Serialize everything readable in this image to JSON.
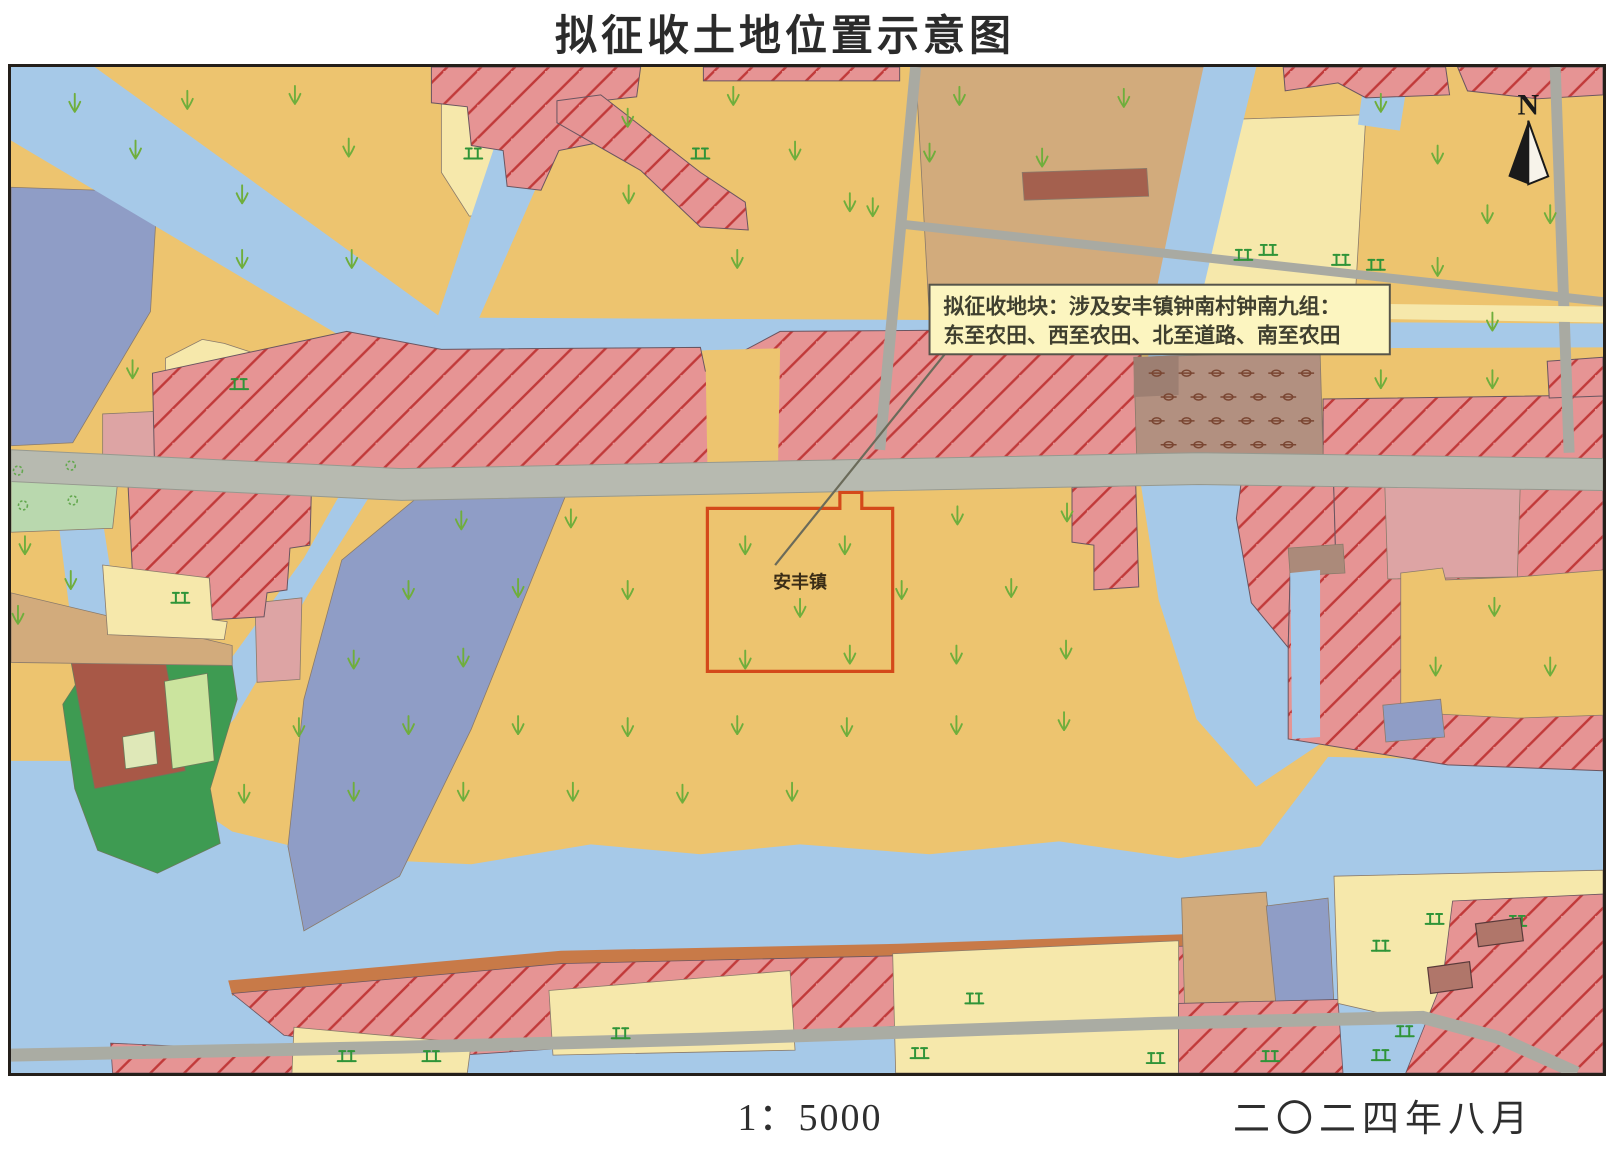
{
  "title": "拟征收土地位置示意图",
  "map": {
    "callout": {
      "line1": "拟征收地块：涉及安丰镇钟南村钟南九组：",
      "line2": "东至农田、西至农田、北至道路、南至农田"
    },
    "parcel_label": "安丰镇",
    "north_label": "N"
  },
  "footer": {
    "scale": "1：5000",
    "date": "二〇二四年八月"
  },
  "legend_colors": {
    "farmland": "#edc46f",
    "paddy_light": "#f6e8ab",
    "water": "#a6c9e8",
    "pond_purple": "#8f9dc6",
    "residential_fill": "#e69494",
    "residential_hatch": "#c13a3a",
    "plain_salmon": "#dda4a4",
    "village_tan": "#d2ab7c",
    "orchard": "#b29080",
    "forest_green": "#3e9b52",
    "building_brick": "#a85847",
    "road_gray": "#b7bab0",
    "rust_bank": "#c87a48",
    "parcel_boundary_red": "#d4491a",
    "callout_bg": "#fcf5c0",
    "crop_symbol_green": "#6fae3c"
  }
}
